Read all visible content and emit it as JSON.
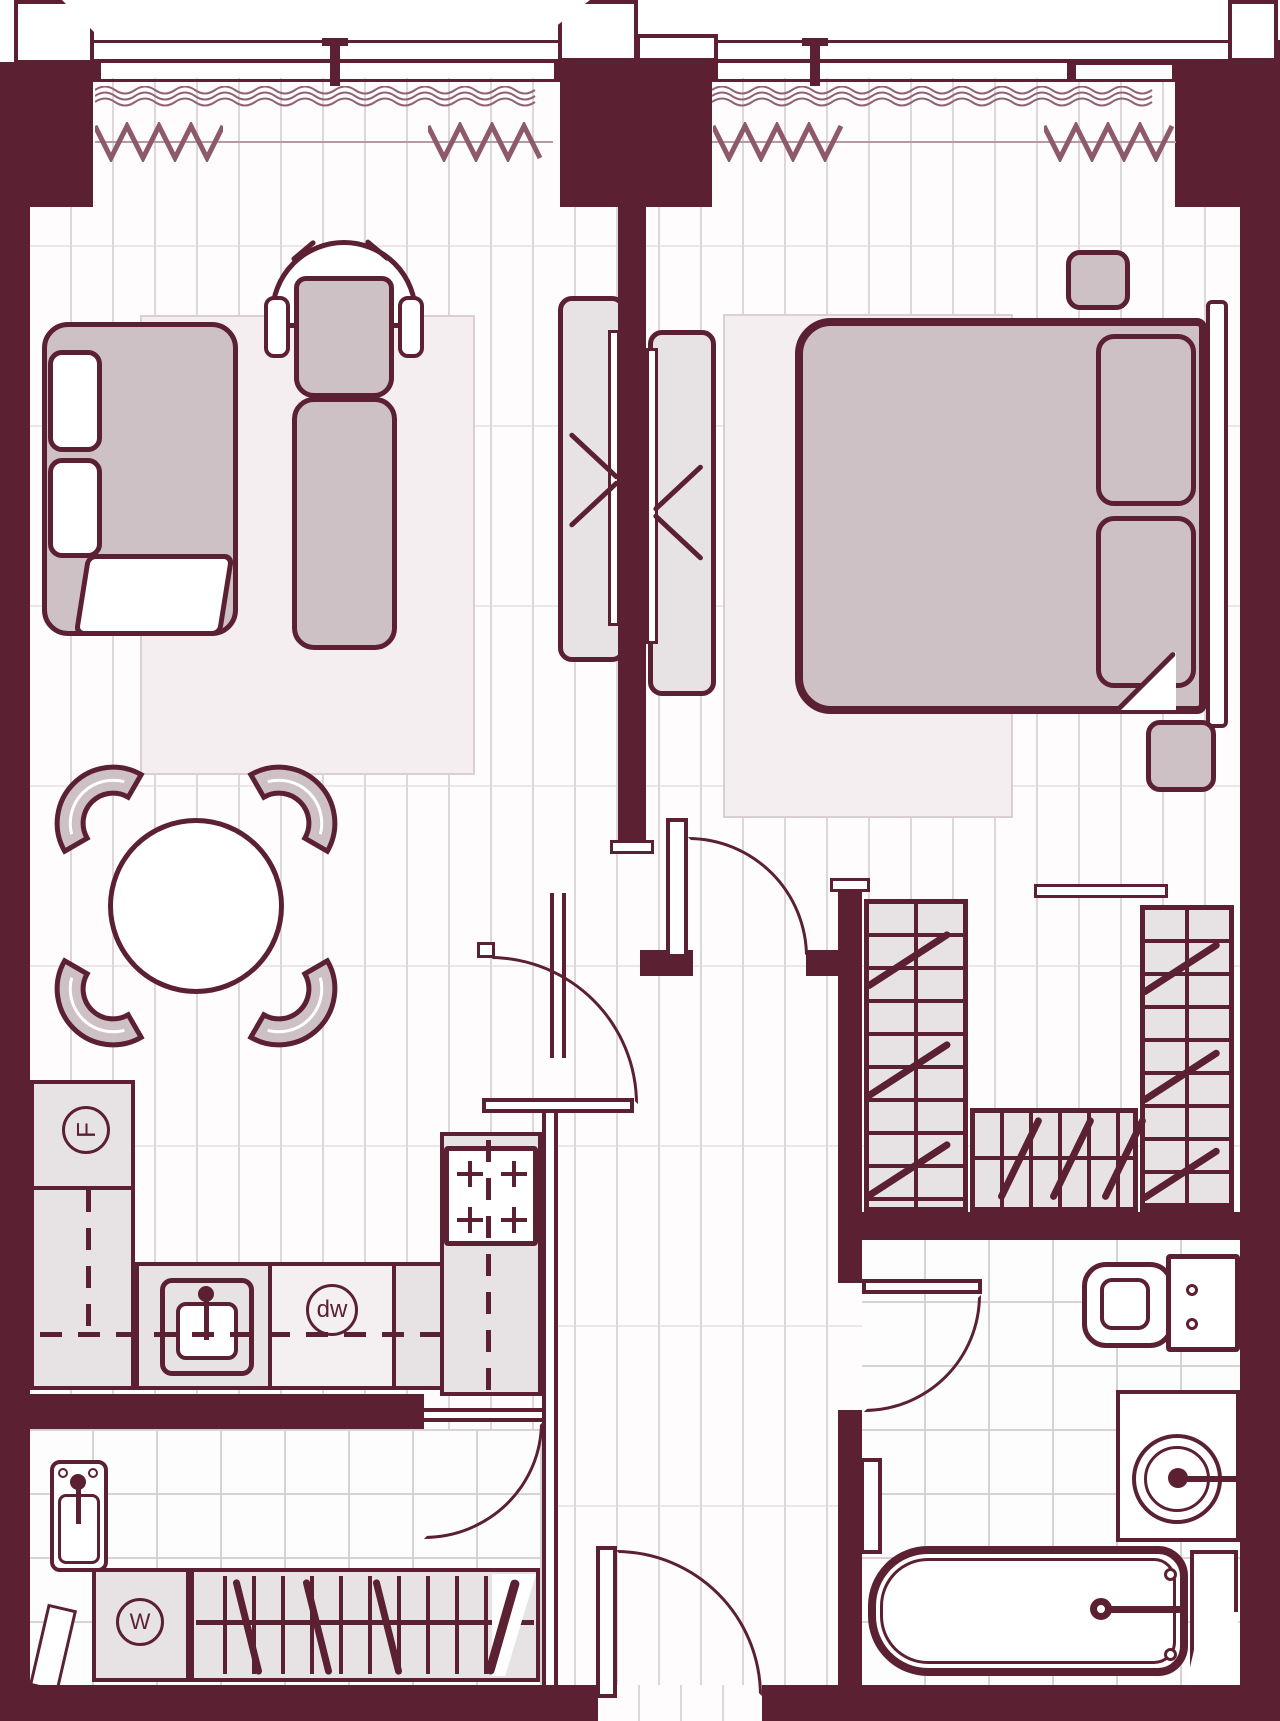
{
  "title": "apartment-floor-plan",
  "labels": {
    "fridge": "F",
    "dishwasher": "dw",
    "washer": "W"
  },
  "colors": {
    "wall": "#5b2032",
    "furniture_mauve": "#cec1c5",
    "furniture_gray": "#e7e3e4",
    "rug": "#f4eef1",
    "floor_line": "#ded7da",
    "tile_line": "#d9d2d5",
    "curtain": "#8f6374",
    "radiator": "#8d5a6b"
  }
}
